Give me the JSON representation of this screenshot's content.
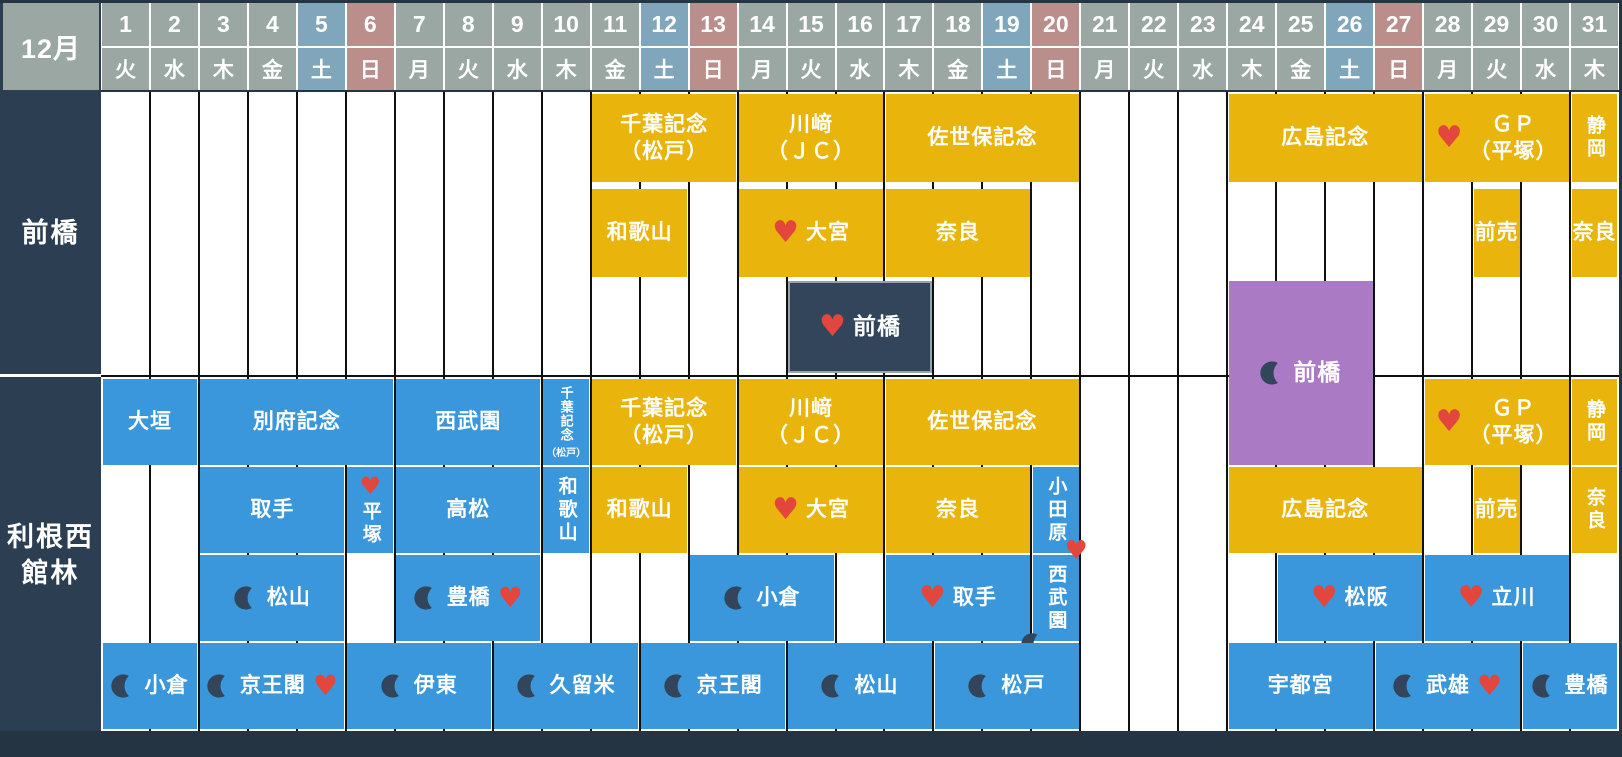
{
  "month_label": "12月",
  "colors": {
    "bg": "#243443",
    "label_bg": "#2C3E51",
    "hdr_normal": "#9AA7A3",
    "hdr_sat": "#7FA6BA",
    "hdr_sun": "#B98E8B",
    "yellow": "#E9B40B",
    "blue": "#3B97DB",
    "purple": "#AA7AC5",
    "dark_event": "#33455B",
    "dark_event_border": "#97A2AC",
    "heart": "#E2463C",
    "moon": "#33455B",
    "grid_line": "#101010",
    "cell_text": "#FFFFFF"
  },
  "icons": {
    "heart": "heart-pickup-icon",
    "moon": "night-race-moon-icon"
  },
  "layout": {
    "grid_left": 101,
    "grid_right": 1619,
    "grid_top": 92,
    "grid_bottom": 731,
    "header": {
      "num_top": 3,
      "num_h": 43,
      "wd_top": 48,
      "wd_h": 42
    },
    "divider_y": 375,
    "rows": {
      "t0": {
        "top": 94,
        "h": 88
      },
      "t1": {
        "top": 189,
        "h": 88
      },
      "t2": {
        "top": 281,
        "h": 92
      },
      "b0": {
        "top": 379,
        "h": 86
      },
      "b1": {
        "top": 467,
        "h": 86
      },
      "b2": {
        "top": 555,
        "h": 86
      },
      "b3": {
        "top": 643,
        "h": 86
      }
    }
  },
  "calendar": {
    "days": [
      {
        "num": "1",
        "weekday": "火",
        "type": "normal"
      },
      {
        "num": "2",
        "weekday": "水",
        "type": "normal"
      },
      {
        "num": "3",
        "weekday": "木",
        "type": "normal"
      },
      {
        "num": "4",
        "weekday": "金",
        "type": "normal"
      },
      {
        "num": "5",
        "weekday": "土",
        "type": "sat"
      },
      {
        "num": "6",
        "weekday": "日",
        "type": "sun"
      },
      {
        "num": "7",
        "weekday": "月",
        "type": "normal"
      },
      {
        "num": "8",
        "weekday": "火",
        "type": "normal"
      },
      {
        "num": "9",
        "weekday": "水",
        "type": "normal"
      },
      {
        "num": "10",
        "weekday": "木",
        "type": "normal"
      },
      {
        "num": "11",
        "weekday": "金",
        "type": "normal"
      },
      {
        "num": "12",
        "weekday": "土",
        "type": "sat"
      },
      {
        "num": "13",
        "weekday": "日",
        "type": "sun"
      },
      {
        "num": "14",
        "weekday": "月",
        "type": "normal"
      },
      {
        "num": "15",
        "weekday": "火",
        "type": "normal"
      },
      {
        "num": "16",
        "weekday": "水",
        "type": "normal"
      },
      {
        "num": "17",
        "weekday": "木",
        "type": "normal"
      },
      {
        "num": "18",
        "weekday": "金",
        "type": "normal"
      },
      {
        "num": "19",
        "weekday": "土",
        "type": "sat"
      },
      {
        "num": "20",
        "weekday": "日",
        "type": "sun"
      },
      {
        "num": "21",
        "weekday": "月",
        "type": "normal"
      },
      {
        "num": "22",
        "weekday": "火",
        "type": "normal"
      },
      {
        "num": "23",
        "weekday": "水",
        "type": "normal"
      },
      {
        "num": "24",
        "weekday": "木",
        "type": "normal"
      },
      {
        "num": "25",
        "weekday": "金",
        "type": "normal"
      },
      {
        "num": "26",
        "weekday": "土",
        "type": "sat"
      },
      {
        "num": "27",
        "weekday": "日",
        "type": "sun"
      },
      {
        "num": "28",
        "weekday": "月",
        "type": "normal"
      },
      {
        "num": "29",
        "weekday": "火",
        "type": "normal"
      },
      {
        "num": "30",
        "weekday": "水",
        "type": "normal"
      },
      {
        "num": "31",
        "weekday": "木",
        "type": "normal"
      }
    ]
  },
  "sections": [
    {
      "id": "maebashi",
      "label": "前橋",
      "label_top": 92,
      "label_h": 282,
      "events": [
        {
          "days": [
            11,
            13
          ],
          "row": "t0",
          "color": "yellow",
          "lines": [
            "千葉記念",
            "（松戸）"
          ]
        },
        {
          "days": [
            14,
            16
          ],
          "row": "t0",
          "color": "yellow",
          "lines": [
            "川﨑",
            "（ＪＣ）"
          ]
        },
        {
          "days": [
            17,
            20
          ],
          "row": "t0",
          "color": "yellow",
          "lines": [
            "佐世保記念"
          ]
        },
        {
          "days": [
            24,
            27
          ],
          "row": "t0",
          "color": "yellow",
          "lines": [
            "広島記念"
          ]
        },
        {
          "days": [
            28,
            30
          ],
          "row": "t0",
          "color": "yellow",
          "lines": [
            "ＧＰ",
            "（平塚）"
          ],
          "heart": "left"
        },
        {
          "days": [
            31,
            31
          ],
          "row": "t0",
          "color": "yellow",
          "lines": [
            "静岡"
          ],
          "vertical": true
        },
        {
          "days": [
            11,
            12
          ],
          "row": "t1",
          "color": "yellow",
          "lines": [
            "和歌山"
          ]
        },
        {
          "days": [
            14,
            16
          ],
          "row": "t1",
          "color": "yellow",
          "lines": [
            "大宮"
          ],
          "heart": "left"
        },
        {
          "days": [
            17,
            19
          ],
          "row": "t1",
          "color": "yellow",
          "lines": [
            "奈良"
          ]
        },
        {
          "days": [
            29,
            29
          ],
          "row": "t1",
          "color": "yellow",
          "lines": [
            "前売"
          ]
        },
        {
          "days": [
            31,
            31
          ],
          "row": "t1",
          "color": "yellow",
          "lines": [
            "奈良"
          ]
        },
        {
          "days": [
            15,
            17
          ],
          "row": "t2",
          "color": "dark",
          "lines": [
            "前橋"
          ],
          "heart": "left",
          "big": true
        },
        {
          "days": [
            24,
            26
          ],
          "row": "span",
          "top": 281,
          "h": 184,
          "color": "purple",
          "lines": [
            "前橋"
          ],
          "moon": "left",
          "big": true
        }
      ]
    },
    {
      "id": "tonenishi-tatebayashi",
      "label": "利根西\n館林",
      "label_top": 379,
      "label_h": 352,
      "events": [
        {
          "days": [
            1,
            2
          ],
          "row": "b0",
          "color": "blue",
          "lines": [
            "大垣"
          ]
        },
        {
          "days": [
            3,
            6
          ],
          "row": "b0",
          "color": "blue",
          "lines": [
            "別府記念"
          ]
        },
        {
          "days": [
            7,
            9
          ],
          "row": "b0",
          "color": "blue",
          "lines": [
            "西武園"
          ]
        },
        {
          "days": [
            10,
            10
          ],
          "row": "b0",
          "color": "blue",
          "lines": [
            "千葉記念",
            "（松戸）"
          ],
          "small": true
        },
        {
          "days": [
            11,
            13
          ],
          "row": "b0",
          "color": "yellow",
          "lines": [
            "千葉記念",
            "（松戸）"
          ]
        },
        {
          "days": [
            14,
            16
          ],
          "row": "b0",
          "color": "yellow",
          "lines": [
            "川﨑",
            "（ＪＣ）"
          ]
        },
        {
          "days": [
            17,
            20
          ],
          "row": "b0",
          "color": "yellow",
          "lines": [
            "佐世保記念"
          ]
        },
        {
          "days": [
            28,
            30
          ],
          "row": "b0",
          "color": "yellow",
          "lines": [
            "ＧＰ",
            "（平塚）"
          ],
          "heart": "left"
        },
        {
          "days": [
            31,
            31
          ],
          "row": "b0",
          "color": "yellow",
          "lines": [
            "静岡"
          ],
          "vertical": true
        },
        {
          "days": [
            3,
            5
          ],
          "row": "b1",
          "color": "blue",
          "lines": [
            "取手"
          ]
        },
        {
          "days": [
            6,
            6
          ],
          "row": "b1",
          "color": "blue",
          "lines": [
            "平塚"
          ],
          "vertical": true,
          "heart": "top"
        },
        {
          "days": [
            7,
            9
          ],
          "row": "b1",
          "color": "blue",
          "lines": [
            "高松"
          ]
        },
        {
          "days": [
            10,
            10
          ],
          "row": "b1",
          "color": "blue",
          "lines": [
            "和歌山"
          ],
          "vertical": true
        },
        {
          "days": [
            11,
            12
          ],
          "row": "b1",
          "color": "yellow",
          "lines": [
            "和歌山"
          ]
        },
        {
          "days": [
            14,
            16
          ],
          "row": "b1",
          "color": "yellow",
          "lines": [
            "大宮"
          ],
          "heart": "left"
        },
        {
          "days": [
            17,
            19
          ],
          "row": "b1",
          "color": "yellow",
          "lines": [
            "奈良"
          ]
        },
        {
          "days": [
            20,
            20
          ],
          "row": "b1",
          "color": "blue",
          "lines": [
            "小田原"
          ],
          "vertical": true
        },
        {
          "days": [
            24,
            27
          ],
          "row": "b1",
          "color": "yellow",
          "lines": [
            "広島記念"
          ]
        },
        {
          "days": [
            29,
            29
          ],
          "row": "b1",
          "color": "yellow",
          "lines": [
            "前売"
          ]
        },
        {
          "days": [
            31,
            31
          ],
          "row": "b1",
          "color": "yellow",
          "lines": [
            "奈良"
          ],
          "vertical": true
        },
        {
          "days": [
            3,
            5
          ],
          "row": "b2",
          "color": "blue",
          "lines": [
            "松山"
          ],
          "moon": "left"
        },
        {
          "days": [
            7,
            9
          ],
          "row": "b2",
          "color": "blue",
          "lines": [
            "豊橋"
          ],
          "moon": "left",
          "heart": "right"
        },
        {
          "days": [
            13,
            15
          ],
          "row": "b2",
          "color": "blue",
          "lines": [
            "小倉"
          ],
          "moon": "left"
        },
        {
          "days": [
            17,
            19
          ],
          "row": "b2",
          "color": "blue",
          "lines": [
            "取手"
          ],
          "heart": "left"
        },
        {
          "days": [
            20,
            20
          ],
          "row": "b2",
          "color": "blue",
          "lines": [
            "西武園"
          ],
          "vertical": true,
          "heart": "topright",
          "moon": "bottomleft"
        },
        {
          "days": [
            25,
            27
          ],
          "row": "b2",
          "color": "blue",
          "lines": [
            "松阪"
          ],
          "heart": "left"
        },
        {
          "days": [
            28,
            30
          ],
          "row": "b2",
          "color": "blue",
          "lines": [
            "立川"
          ],
          "heart": "left"
        },
        {
          "days": [
            1,
            2
          ],
          "row": "b3",
          "color": "blue",
          "lines": [
            "小倉"
          ],
          "moon": "left"
        },
        {
          "days": [
            3,
            5
          ],
          "row": "b3",
          "color": "blue",
          "lines": [
            "京王閣"
          ],
          "moon": "left",
          "heart": "right"
        },
        {
          "days": [
            6,
            8
          ],
          "row": "b3",
          "color": "blue",
          "lines": [
            "伊東"
          ],
          "moon": "left"
        },
        {
          "days": [
            9,
            11
          ],
          "row": "b3",
          "color": "blue",
          "lines": [
            "久留米"
          ],
          "moon": "left"
        },
        {
          "days": [
            12,
            14
          ],
          "row": "b3",
          "color": "blue",
          "lines": [
            "京王閣"
          ],
          "moon": "left"
        },
        {
          "days": [
            15,
            17
          ],
          "row": "b3",
          "color": "blue",
          "lines": [
            "松山"
          ],
          "moon": "left"
        },
        {
          "days": [
            18,
            20
          ],
          "row": "b3",
          "color": "blue",
          "lines": [
            "松戸"
          ],
          "moon": "left"
        },
        {
          "days": [
            24,
            26
          ],
          "row": "b3",
          "color": "blue",
          "lines": [
            "宇都宮"
          ]
        },
        {
          "days": [
            27,
            29
          ],
          "row": "b3",
          "color": "blue",
          "lines": [
            "武雄"
          ],
          "moon": "left",
          "heart": "right"
        },
        {
          "days": [
            30,
            31
          ],
          "row": "b3",
          "color": "blue",
          "lines": [
            "豊橋"
          ],
          "moon": "left"
        }
      ]
    }
  ]
}
